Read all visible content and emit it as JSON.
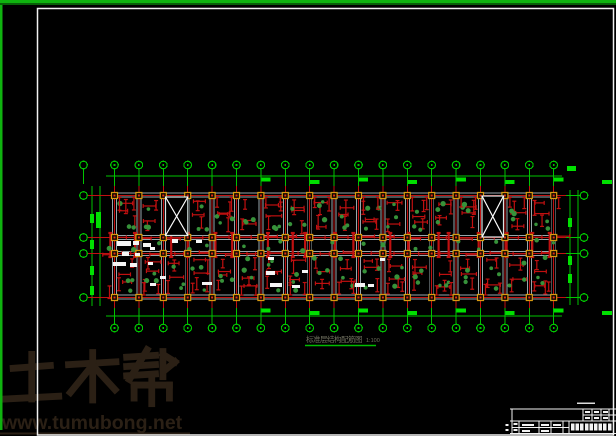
{
  "sheet": {
    "width": 616,
    "height": 436,
    "background": "#000000"
  },
  "colors": {
    "border_green": "#0da50d",
    "cad_green": "#00c400",
    "cad_green_bright": "#00e000",
    "cad_red": "#c01010",
    "beam_gray": "#97a6ab",
    "column_accent": "#d89a10",
    "frame_white": "#f2f2f2",
    "stair_border": "#d7e4e4",
    "note_white": "#f5f5f5",
    "watermark_brown": "#2b2015",
    "title_text": "#70705f",
    "title_underline": "#00bb00",
    "green_dot": "#37923a"
  },
  "watermark": {
    "brand": "土木帮",
    "url": "www.tumubong.net"
  },
  "drawing_title": {
    "text": "标准层结构配筋图",
    "scale": "1:100"
  },
  "structural_grid": {
    "columns": 19,
    "rows": 4,
    "col_start": 114.5,
    "col_spacing": 24.4,
    "row_ys": [
      195.5,
      237.5,
      253.5,
      297.5
    ],
    "plan": {
      "x1": 113,
      "y1": 192,
      "x2": 556,
      "y2": 299
    },
    "top_bubble_y": 165,
    "bottom_bubble_y": 328,
    "left_bubble_x": 83.5,
    "right_bubble_x": 584,
    "top_dim_line_y": 176,
    "bottom_dim_line_y": 316,
    "bubble_radius": 3.8,
    "stairwells": [
      {
        "x": 165.5,
        "y": 197,
        "w": 22.3,
        "h": 38.5
      },
      {
        "x": 482,
        "y": 196,
        "w": 21.5,
        "h": 41
      }
    ]
  },
  "title_block": {
    "position": "bottom-right",
    "top_y": 409,
    "left_x": 512,
    "rows": 2,
    "legible_text": ""
  }
}
